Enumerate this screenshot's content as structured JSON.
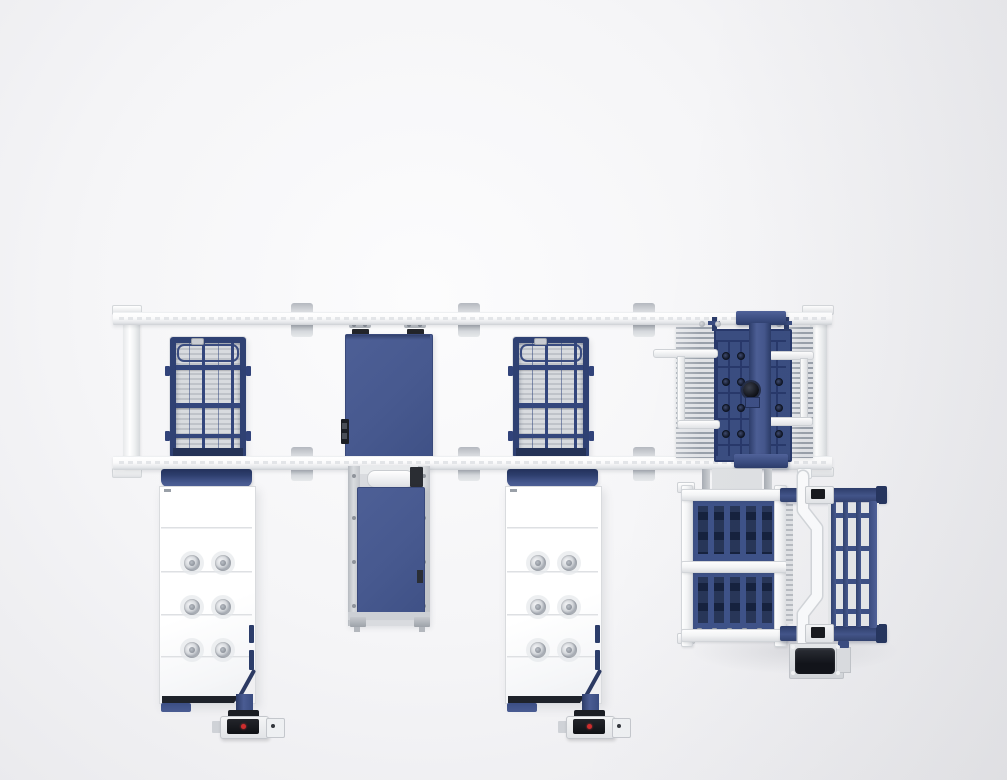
{
  "meta": {
    "description": "Top-down 3D render of an automated sheet-metal laser cutting production line: an overhead gantry with two white rails, two laser cutting tables with navy mesh beds and white side cabinets, a blue shuttle exchange table, a comb-fork material transfer unit riding the gantry, and a pallet loading rack with tilt pallet and drive motor. No on-screen text.",
    "visible_text": []
  },
  "palette": {
    "page_bg": "#f2f2f4",
    "rail_white": "#fbfcfd",
    "steel_blue": "#47598f",
    "steel_blue_dark": "#3a4c80",
    "navy": "#2e3f6e",
    "navy_deep": "#15213d",
    "mesh_gray": "#c9ccd2",
    "metal_gray": "#c3c6cb",
    "dark_gray": "#8f959d",
    "near_black": "#17191f",
    "panel_white": "#ffffff",
    "red_indicator": "#cf2d2d",
    "green_indicator": "#3db54a"
  },
  "components": [
    "overhead-gantry-rails",
    "left-cutting-table-mesh-bed",
    "left-machine-cabinet",
    "center-shuttle-table",
    "center-exchange-station",
    "right-cutting-table-mesh-bed",
    "right-machine-cabinet",
    "comb-transfer-unit",
    "pallet-rack",
    "tilt-pallet",
    "drive-motor"
  ]
}
